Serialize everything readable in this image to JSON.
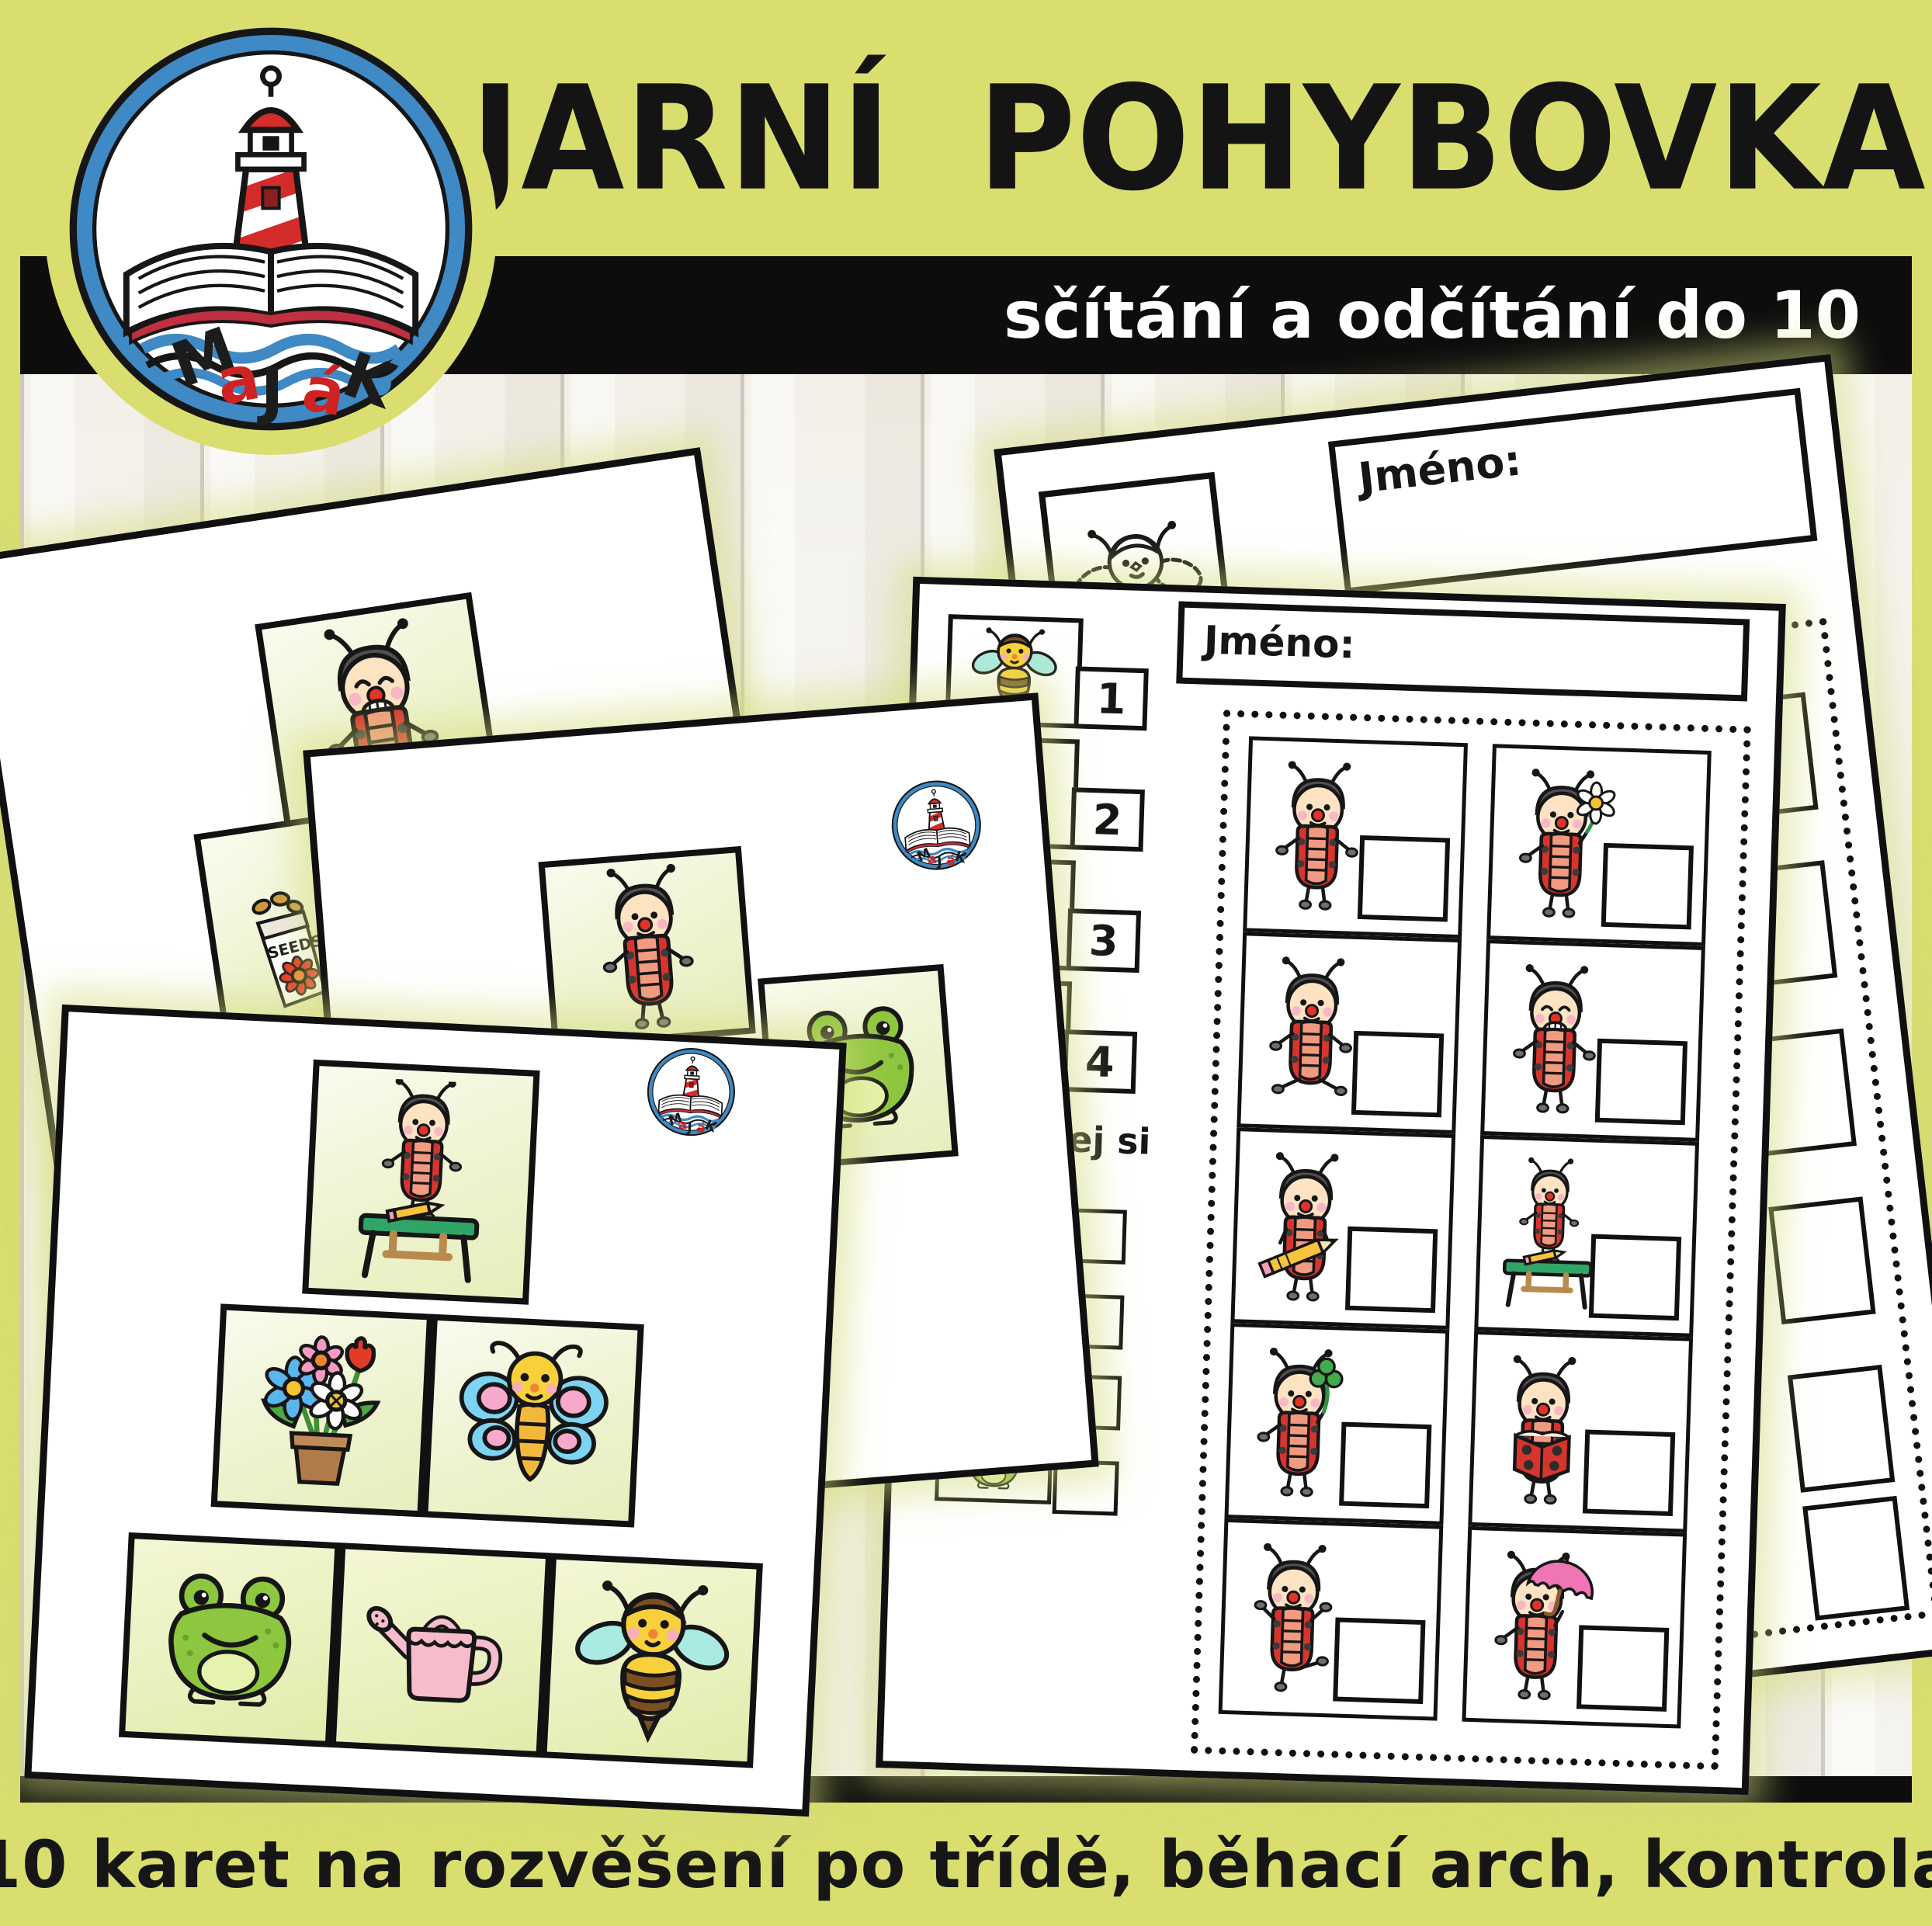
{
  "colors": {
    "accent_green": "#d9de6e",
    "bar_black": "#0d0d0d",
    "ladybug_red": "#d8342e",
    "paper_white": "#ffffff",
    "subtitle_text": "#ffffff"
  },
  "header": {
    "title": "JARNÍ POHYBOVKA",
    "subtitle": "sčítání a odčítání do 10",
    "logo": {
      "name": "MaJáK",
      "letters": [
        {
          "ch": "M",
          "color": "#1c1c1c"
        },
        {
          "ch": "a",
          "color": "#cf2222"
        },
        {
          "ch": "J",
          "color": "#1c1c1c"
        },
        {
          "ch": "á",
          "color": "#cf2222"
        },
        {
          "ch": "K",
          "color": "#1c1c1c"
        }
      ]
    }
  },
  "footer": {
    "text": "10 karet na rozvěšení po třídě, běhací arch, kontrola"
  },
  "seed_packet_label": "SEEDS",
  "logo_icon": "majak-logo",
  "worksheet_front": {
    "name_label": "Jméno:",
    "legend": [
      {
        "icon": "bee",
        "number": "1"
      },
      {
        "icon": "watering-can",
        "number": "2"
      },
      {
        "icon": "butterfly",
        "number": "3"
      },
      {
        "icon": "seed-packet",
        "number": "4"
      }
    ],
    "section_label": "počítej si",
    "count_items": [
      {
        "icon": "flower-pot"
      },
      {
        "icon": "sun-hat"
      },
      {
        "icon": "garden-hose"
      },
      {
        "icon": "frog"
      }
    ],
    "grid": {
      "rows": [
        [
          {
            "icon": "ladybug-standing"
          },
          {
            "icon": "ladybug-with-daisy"
          }
        ],
        [
          {
            "icon": "ladybug-sitting"
          },
          {
            "icon": "ladybug-grinning"
          }
        ],
        [
          {
            "icon": "ladybug-with-pencil"
          },
          {
            "icon": "ladybug-at-desk"
          }
        ],
        [
          {
            "icon": "ladybug-with-clover"
          },
          {
            "icon": "ladybug-reading-book"
          }
        ],
        [
          {
            "icon": "ladybug-dancing"
          },
          {
            "icon": "ladybug-with-umbrella"
          }
        ]
      ]
    }
  },
  "worksheet_back": {
    "name_label": "Jméno:",
    "legend_first": {
      "icon": "bee-outline",
      "number": "1"
    }
  },
  "cards": {
    "top": {
      "images": [
        {
          "icon": "ladybug-grinning"
        },
        {
          "icon": "seed-packet"
        }
      ]
    },
    "middle": {
      "logo": "majak-logo",
      "images": [
        {
          "icon": "ladybug-smiling"
        },
        {
          "icon": "frog"
        }
      ]
    },
    "front": {
      "logo": "majak-logo",
      "pyramid": {
        "top": [
          {
            "icon": "ladybug-at-desk"
          }
        ],
        "middle": [
          {
            "icon": "flower-pot"
          },
          {
            "icon": "butterfly"
          }
        ],
        "bottom": [
          {
            "icon": "frog"
          },
          {
            "icon": "watering-can"
          },
          {
            "icon": "bee"
          }
        ]
      }
    }
  }
}
